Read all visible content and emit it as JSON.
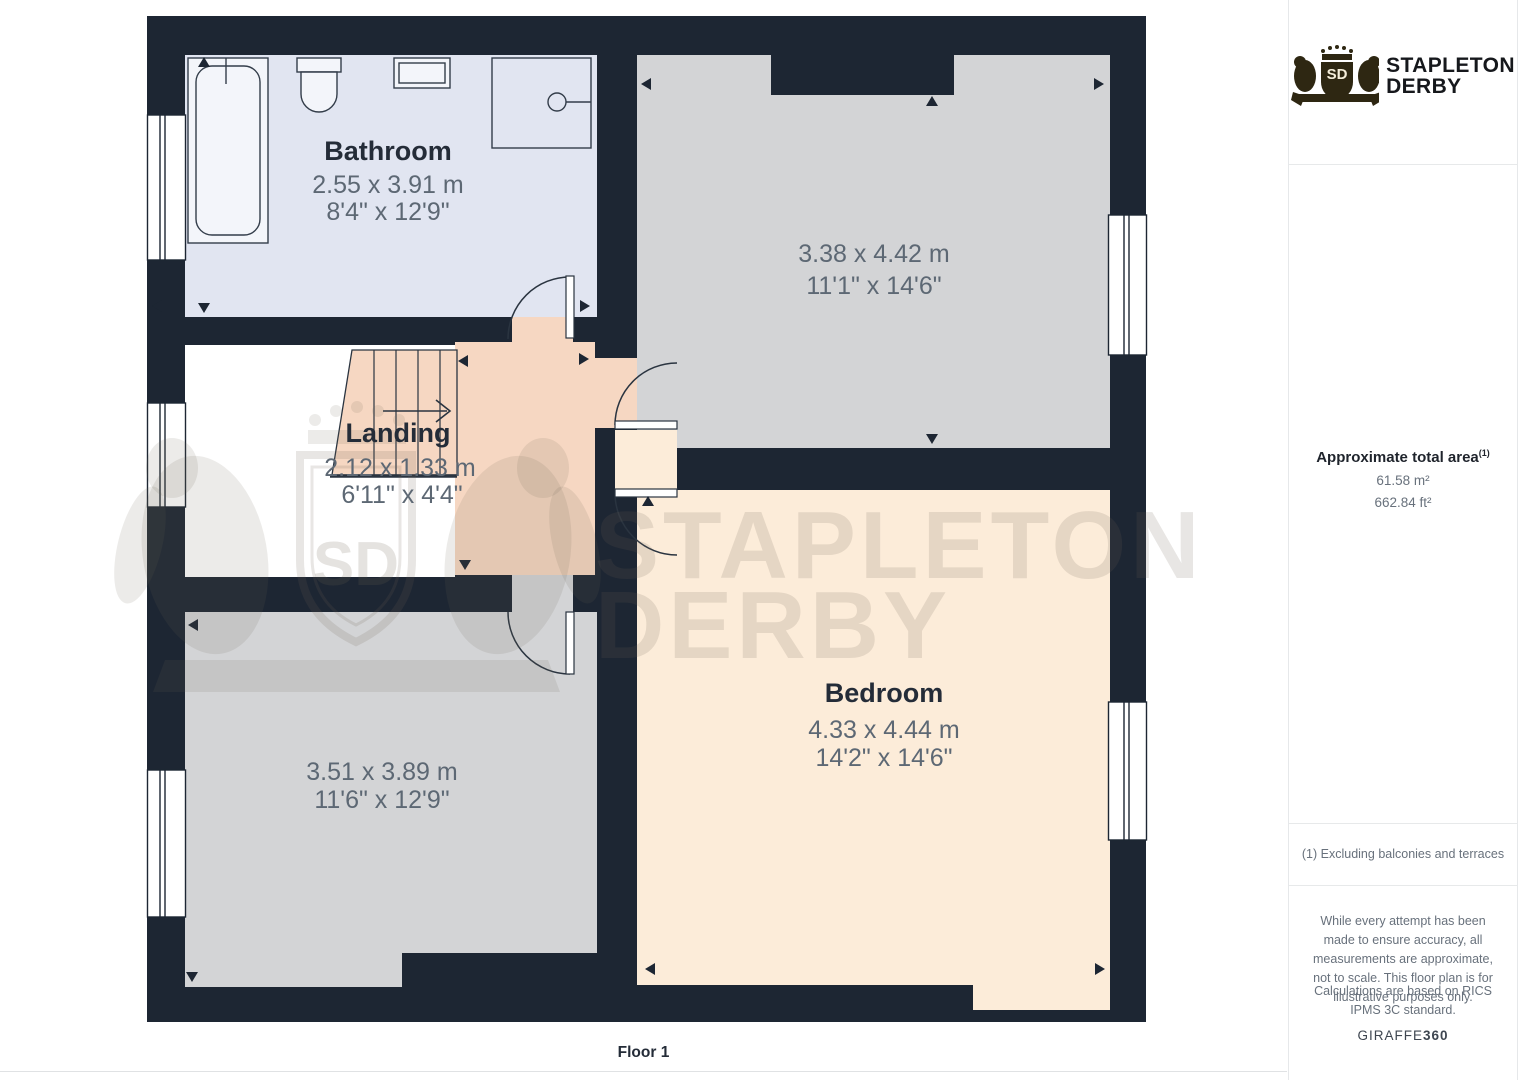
{
  "plan": {
    "floor_label": "Floor 1",
    "rooms": {
      "bathroom": {
        "name": "Bathroom",
        "dim_m": "2.55 x 3.91 m",
        "dim_ft": "8'4\" x 12'9\""
      },
      "top_right": {
        "dim_m": "3.38 x 4.42 m",
        "dim_ft": "11'1\" x 14'6\""
      },
      "landing": {
        "name": "Landing",
        "dim_m": "2.12 x 1.33 m",
        "dim_ft": "6'11\" x 4'4\""
      },
      "bottom_left": {
        "dim_m": "3.51 x 3.89 m",
        "dim_ft": "11'6\" x 12'9\""
      },
      "bedroom": {
        "name": "Bedroom",
        "dim_m": "4.33 x 4.44 m",
        "dim_ft": "14'2\" x 14'6\""
      }
    },
    "watermark": {
      "line1": "STAPLETON",
      "line2": "DERBY",
      "initials": "SD"
    }
  },
  "sidebar": {
    "logo": {
      "line1": "STAPLETON",
      "line2": "DERBY",
      "initials": "SD"
    },
    "area": {
      "title": "Approximate total area",
      "superscript": "(1)",
      "metric": "61.58 m²",
      "imperial": "662.84 ft²"
    },
    "footnote": "(1) Excluding balconies and terraces",
    "disclaimer_1": "While every attempt has been made to ensure accuracy, all measurements are approximate, not to scale. This floor plan is for illustrative purposes only.",
    "disclaimer_2": "Calculations are based on RICS IPMS 3C standard.",
    "brand_footer": {
      "name": "GIRAFFE",
      "suffix": "360"
    }
  },
  "colors": {
    "wall": "#1d2633",
    "bathroom_floor": "#e1e5f1",
    "gray_room_floor": "#d3d4d6",
    "bedroom_floor": "#fcecd9",
    "landing_floor": "#f6d7c2",
    "window": "#ffffff",
    "label_dark": "#242c38",
    "dim_gray": "#5d6874",
    "logo_gold": "#2e2712"
  }
}
